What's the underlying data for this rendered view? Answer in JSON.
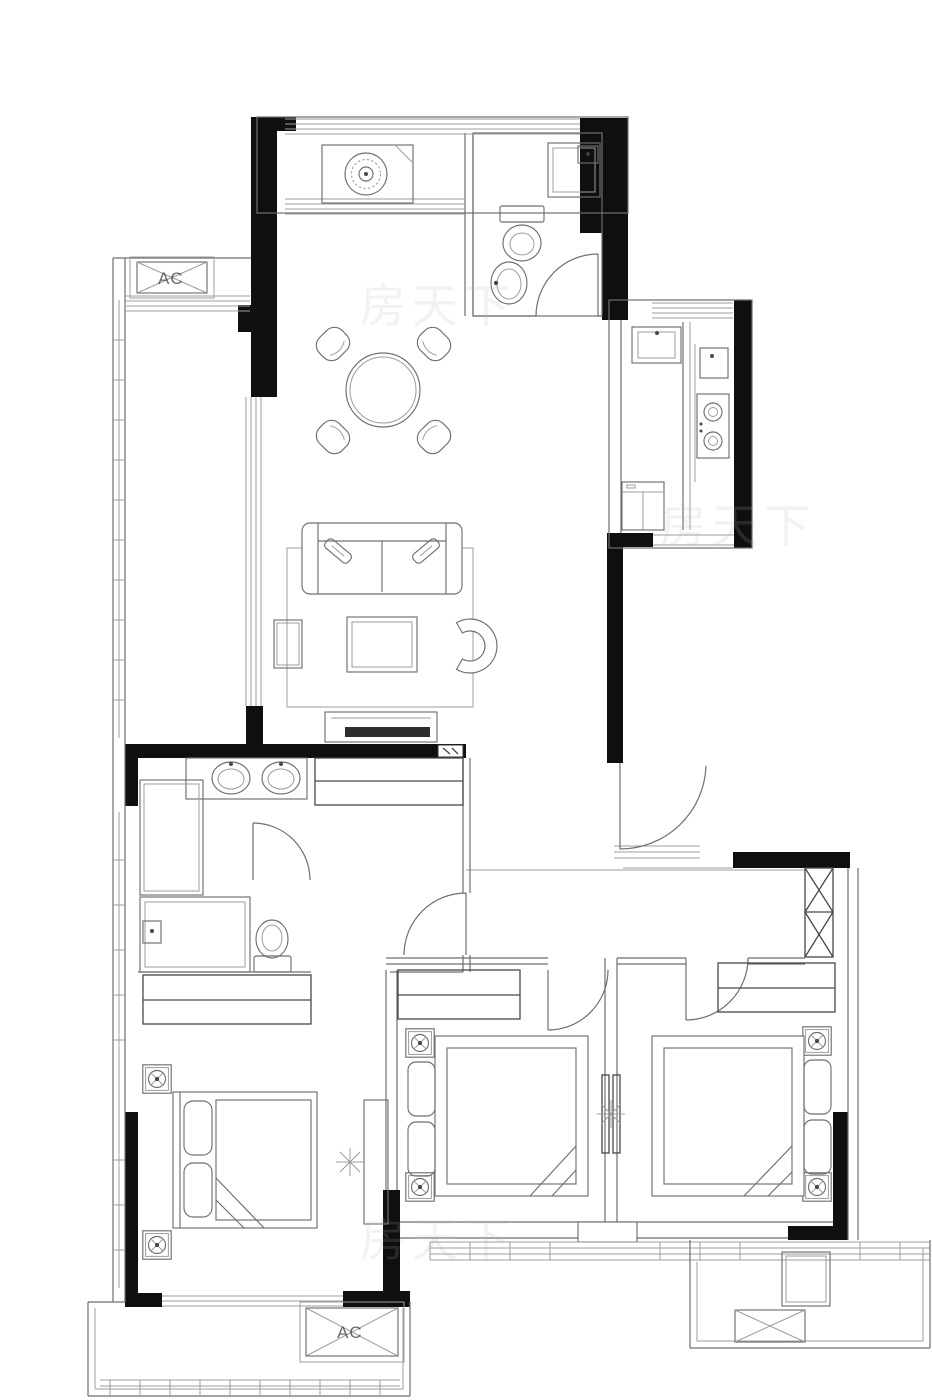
{
  "meta": {
    "type": "architectural-floor-plan",
    "style": "black-and-white line drawing",
    "units_visible": false
  },
  "palette": {
    "background": "#ffffff",
    "wall_fill": "#0f0f0f",
    "line": "#6f6f6f",
    "line_light": "#9c9c9c",
    "line_dark": "#474747",
    "tv_fill": "#2e2e2e",
    "watermark": "#aeb4ba"
  },
  "labels": {
    "ac_unit": "AC"
  },
  "watermark": {
    "text": "房天下",
    "opacity": 0.16
  },
  "rooms": [
    "north-balcony",
    "guest-bathroom",
    "dining-area",
    "kitchen",
    "entry-hall",
    "living-area",
    "west-balcony",
    "master-bathroom",
    "corridor",
    "master-bedroom",
    "bedroom-2",
    "bedroom-3",
    "south-balcony",
    "service-ledge"
  ],
  "fixtures": [
    "washing-machine-icon",
    "shower-icon",
    "toilet-icon",
    "hand-basin-icon",
    "dining-table-icon",
    "dining-chair-icon",
    "kitchen-sink-icon",
    "gas-stove-icon",
    "refrigerator-icon",
    "door-swing-icon",
    "sofa-icon",
    "coffee-table-icon",
    "armchair-icon",
    "side-table-icon",
    "tv-console-icon",
    "double-vanity-icon",
    "wardrobe-hatch-icon",
    "double-bed-icon",
    "pillow-icon",
    "nightstand-rosette-icon",
    "ac-platform-icon",
    "duct-shaft-icon",
    "window-band-icon",
    "partition-sparkle-icon"
  ]
}
